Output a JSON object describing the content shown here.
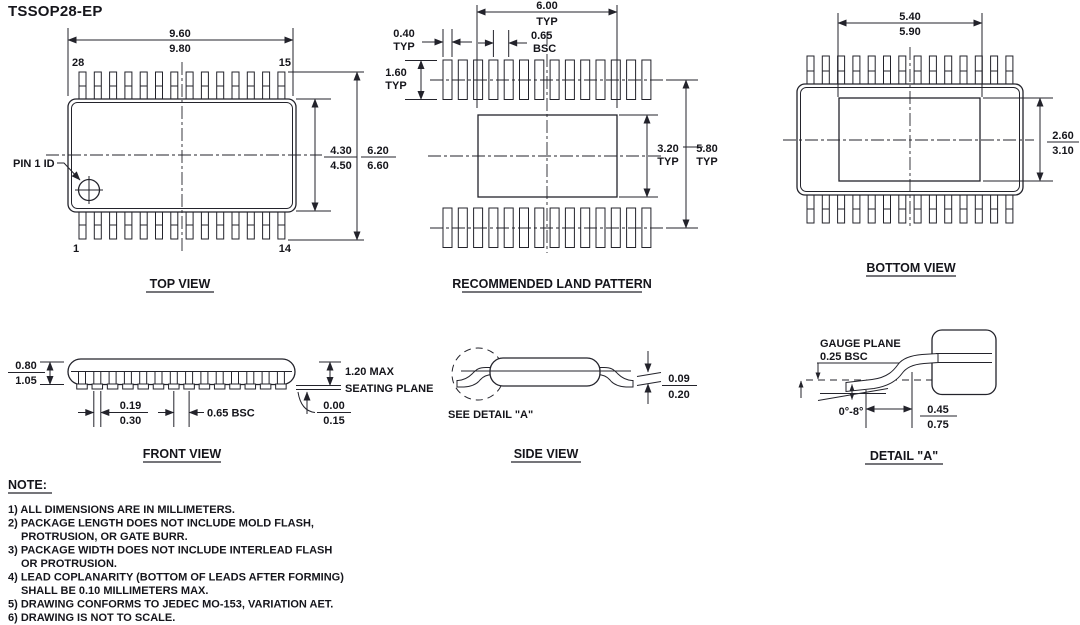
{
  "title": "TSSOP28-EP",
  "views": {
    "top": {
      "label": "TOP VIEW",
      "pin1_label": "PIN 1 ID",
      "pin_top_left": "28",
      "pin_top_right": "15",
      "pin_bottom_left": "1",
      "pin_bottom_right": "14",
      "dim_length": {
        "upper": "9.60",
        "lower": "9.80"
      },
      "dim_body_width": {
        "upper": "4.30",
        "lower": "4.50"
      },
      "dim_overall_width": {
        "upper": "6.20",
        "lower": "6.60"
      }
    },
    "land_pattern": {
      "label": "RECOMMENDED LAND PATTERN",
      "dim_span": {
        "value": "6.00",
        "qual": "TYP"
      },
      "dim_pad_width": {
        "value": "0.40",
        "qual": "TYP"
      },
      "dim_pitch": {
        "value": "0.65",
        "qual": "BSC"
      },
      "dim_pad_length": {
        "value": "1.60",
        "qual": "TYP"
      },
      "dim_thermal_height": {
        "value": "3.20",
        "qual": "TYP"
      },
      "dim_row_span": {
        "value": "5.80",
        "qual": "TYP"
      }
    },
    "bottom": {
      "label": "BOTTOM VIEW",
      "dim_pad_width": {
        "upper": "5.40",
        "lower": "5.90"
      },
      "dim_pad_height": {
        "upper": "2.60",
        "lower": "3.10"
      }
    },
    "front": {
      "label": "FRONT VIEW",
      "dim_body_thickness": {
        "upper": "0.80",
        "lower": "1.05"
      },
      "dim_height_max": "1.20 MAX",
      "seating_plane_label": "SEATING PLANE",
      "dim_lead_width": {
        "upper": "0.19",
        "lower": "0.30"
      },
      "dim_pitch": "0.65 BSC",
      "dim_standoff": {
        "upper": "0.00",
        "lower": "0.15"
      }
    },
    "side": {
      "label": "SIDE VIEW",
      "see_detail_label": "SEE DETAIL \"A\"",
      "dim_lead_thickness": {
        "upper": "0.09",
        "lower": "0.20"
      }
    },
    "detail_a": {
      "label": "DETAIL \"A\"",
      "gauge_plane_label": "GAUGE PLANE",
      "gauge_offset": "0.25 BSC",
      "lead_angle": "0°-8°",
      "dim_foot_length": {
        "upper": "0.45",
        "lower": "0.75"
      }
    }
  },
  "notes": {
    "heading": "NOTE:",
    "lines": [
      "1) ALL DIMENSIONS ARE IN MILLIMETERS.",
      "2) PACKAGE LENGTH DOES NOT INCLUDE MOLD FLASH,",
      "PROTRUSION, OR GATE BURR.",
      "3) PACKAGE WIDTH DOES NOT INCLUDE INTERLEAD FLASH",
      "OR PROTRUSION.",
      "4) LEAD COPLANARITY (BOTTOM OF LEADS AFTER FORMING)",
      "SHALL BE 0.10 MILLIMETERS MAX.",
      "5) DRAWING CONFORMS TO JEDEC MO-153, VARIATION AET.",
      "6) DRAWING IS NOT TO SCALE."
    ]
  },
  "colors": {
    "line": "#23232b",
    "text": "#15151b",
    "background": "#ffffff"
  }
}
